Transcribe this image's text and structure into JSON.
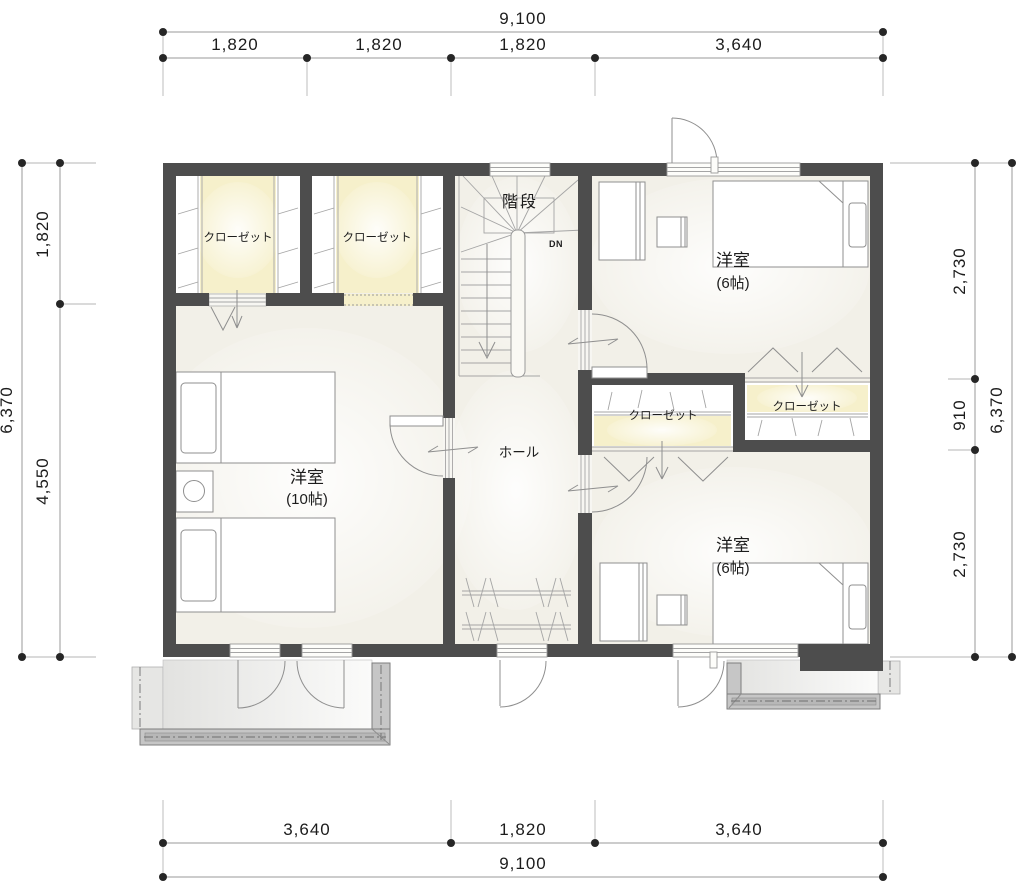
{
  "drawing": {
    "type": "floor-plan",
    "labels": {
      "room_large": {
        "name": "洋室",
        "size": "(10帖)"
      },
      "room_upper_right": {
        "name": "洋室",
        "size": "(6帖)"
      },
      "room_lower_right": {
        "name": "洋室",
        "size": "(6帖)"
      },
      "hall": "ホール",
      "stairs": "階段",
      "stairs_direction": "DN",
      "closet": "クローゼット"
    },
    "dimensions": {
      "top": {
        "total": "9,100",
        "segments": [
          "1,820",
          "1,820",
          "1,820",
          "3,640"
        ]
      },
      "bottom": {
        "total": "9,100",
        "segments": [
          "3,640",
          "1,820",
          "3,640"
        ]
      },
      "left": {
        "total": "6,370",
        "segments": [
          "1,820",
          "4,550"
        ]
      },
      "right": {
        "total": "6,370",
        "segments": [
          "2,730",
          "910",
          "2,730"
        ]
      }
    },
    "colors": {
      "wall": "#4d4d4d",
      "floor": "#f2f0e8",
      "closet_fill": "#f6f0cb",
      "line": "#8f8f8f",
      "balcony_rail": "#c6c6c6",
      "dimension_text": "#1c1c1c"
    }
  }
}
